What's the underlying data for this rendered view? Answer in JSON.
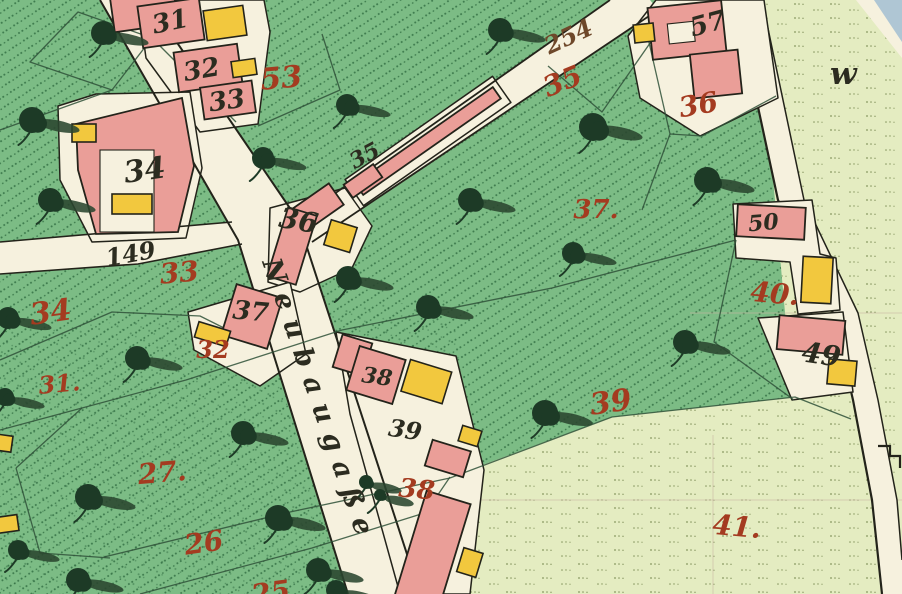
{
  "map": {
    "street_name": "Neubaugaße",
    "meadow_mark": "w",
    "colors": {
      "paper": "#f3eedb",
      "road": "#f6f1de",
      "garden": "#7cbc85",
      "meadow": "#e4ecc1",
      "building_pink": "#ea9e98",
      "building_yellow": "#f2c83e",
      "outline": "#23231a",
      "boundary": "#2f5138",
      "dot_green": "#2d6a3f",
      "mdot": "#6d7f46",
      "label_red": "#a43b20",
      "label_black": "#2c2c20",
      "label_brown": "#6e482a",
      "tree": "#1d3a26",
      "tree_shadow": "#2a452f",
      "water_blue": "#afc6d4",
      "grid": "#c9b6a2"
    },
    "parcel_numbers_red": [
      {
        "text": "53",
        "x": 282,
        "y": 88,
        "rot": -5,
        "size": 30
      },
      {
        "text": "35",
        "x": 566,
        "y": 90,
        "rot": -22,
        "size": 28
      },
      {
        "text": "36",
        "x": 700,
        "y": 114,
        "rot": -10,
        "size": 28
      },
      {
        "text": "37.",
        "x": 596,
        "y": 218,
        "rot": 0,
        "size": 26
      },
      {
        "text": "33",
        "x": 180,
        "y": 282,
        "rot": -5,
        "size": 28
      },
      {
        "text": "34",
        "x": 52,
        "y": 322,
        "rot": -8,
        "size": 30
      },
      {
        "text": "32",
        "x": 213,
        "y": 358,
        "rot": 0,
        "size": 24
      },
      {
        "text": "31.",
        "x": 60,
        "y": 392,
        "rot": -5,
        "size": 24
      },
      {
        "text": "27.",
        "x": 163,
        "y": 482,
        "rot": -5,
        "size": 28
      },
      {
        "text": "26",
        "x": 205,
        "y": 552,
        "rot": -8,
        "size": 28
      },
      {
        "text": "25",
        "x": 272,
        "y": 602,
        "rot": -8,
        "size": 28
      },
      {
        "text": "38",
        "x": 416,
        "y": 498,
        "rot": 5,
        "size": 26
      },
      {
        "text": "39",
        "x": 612,
        "y": 412,
        "rot": -8,
        "size": 30
      },
      {
        "text": "40.",
        "x": 774,
        "y": 303,
        "rot": 5,
        "size": 28
      },
      {
        "text": "41.",
        "x": 736,
        "y": 536,
        "rot": 5,
        "size": 28
      }
    ],
    "path_number_brown": {
      "text": "254",
      "x": 572,
      "y": 44,
      "rot": -25,
      "size": 24
    },
    "house_numbers_black": [
      {
        "text": "31",
        "x": 172,
        "y": 30,
        "rot": -12,
        "size": 26
      },
      {
        "text": "32",
        "x": 203,
        "y": 78,
        "rot": -10,
        "size": 26
      },
      {
        "text": "33",
        "x": 228,
        "y": 109,
        "rot": -8,
        "size": 26
      },
      {
        "text": "34",
        "x": 146,
        "y": 180,
        "rot": -8,
        "size": 30
      },
      {
        "text": "35",
        "x": 368,
        "y": 162,
        "rot": -28,
        "size": 22
      },
      {
        "text": "36",
        "x": 297,
        "y": 230,
        "rot": 10,
        "size": 28
      },
      {
        "text": "37",
        "x": 250,
        "y": 320,
        "rot": 5,
        "size": 26
      },
      {
        "text": "38",
        "x": 376,
        "y": 384,
        "rot": 8,
        "size": 22
      },
      {
        "text": "39",
        "x": 404,
        "y": 438,
        "rot": 8,
        "size": 24
      },
      {
        "text": "149",
        "x": 132,
        "y": 262,
        "rot": -10,
        "size": 24
      },
      {
        "text": "57",
        "x": 710,
        "y": 32,
        "rot": -15,
        "size": 26
      },
      {
        "text": "50",
        "x": 764,
        "y": 230,
        "rot": -5,
        "size": 22
      },
      {
        "text": "49",
        "x": 820,
        "y": 364,
        "rot": 8,
        "size": 28
      }
    ],
    "trees": [
      [
        103,
        33,
        12
      ],
      [
        32,
        120,
        13
      ],
      [
        50,
        200,
        12
      ],
      [
        263,
        158,
        11
      ],
      [
        347,
        105,
        11
      ],
      [
        500,
        30,
        12
      ],
      [
        593,
        127,
        14
      ],
      [
        707,
        180,
        13
      ],
      [
        470,
        200,
        12
      ],
      [
        573,
        253,
        11
      ],
      [
        428,
        307,
        12
      ],
      [
        348,
        278,
        12
      ],
      [
        137,
        358,
        12
      ],
      [
        8,
        318,
        11
      ],
      [
        5,
        397,
        9
      ],
      [
        243,
        433,
        12
      ],
      [
        88,
        497,
        13
      ],
      [
        278,
        518,
        13
      ],
      [
        18,
        550,
        10
      ],
      [
        78,
        580,
        12
      ],
      [
        318,
        570,
        12
      ],
      [
        336,
        590,
        10
      ],
      [
        545,
        413,
        13
      ],
      [
        685,
        342,
        12
      ],
      [
        366,
        482,
        7
      ],
      [
        380,
        495,
        6
      ]
    ]
  }
}
